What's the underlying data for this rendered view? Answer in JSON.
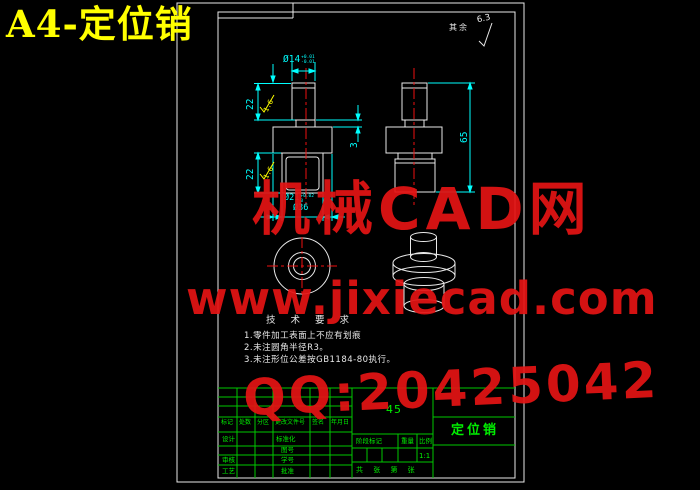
{
  "title": "A4-定位销",
  "surface_note": {
    "label": "其余",
    "value": "6.3"
  },
  "dims": {
    "stem_dia": "Ø14",
    "stem_dia_tol_up": "+0.01",
    "stem_dia_tol_dn": "-0.01",
    "stem_len": "22",
    "body_len": "22",
    "neck_h": "3",
    "overall_h": "65",
    "body_dia": "Ø21",
    "body_dia_tol_up": "+0.02",
    "body_dia_tol_dn": "0",
    "flange_dia": "Ø36",
    "rough_a": "1.6",
    "rough_b": "1.6"
  },
  "tech": {
    "title": "技 术 要 求",
    "items": [
      "1.零件加工表面上不应有划痕",
      "2.未注圆角半径R3。",
      "3.未注形位公差按GB1184-80执行。"
    ]
  },
  "title_block": {
    "material": "45",
    "part_name": "定位销",
    "scale_value": "1:1",
    "header": [
      "标记",
      "处数",
      "分区",
      "更改文件号",
      "签名",
      "年月日"
    ],
    "left_labels": [
      "设计",
      "审核",
      "工艺"
    ],
    "mid_labels": [
      "标准化",
      "图号",
      "学号",
      "批准"
    ],
    "stage_label": "阶段标记",
    "weight_label": "重量",
    "scale_label": "比例",
    "sheets_label": "共 张 第 张"
  },
  "watermark": {
    "line1": "机械CAD网",
    "line2": "www.jixiecad.com",
    "line3": "QQ:20425042"
  },
  "colors": {
    "line_white": "#e9e9e9",
    "dim_cyan": "#00ffff",
    "rough_yellow": "#ffff00",
    "center_red": "#ee1111",
    "table_green": "#00c800",
    "watermark_red": "#e41414",
    "title_yellow": "#ffff00"
  }
}
